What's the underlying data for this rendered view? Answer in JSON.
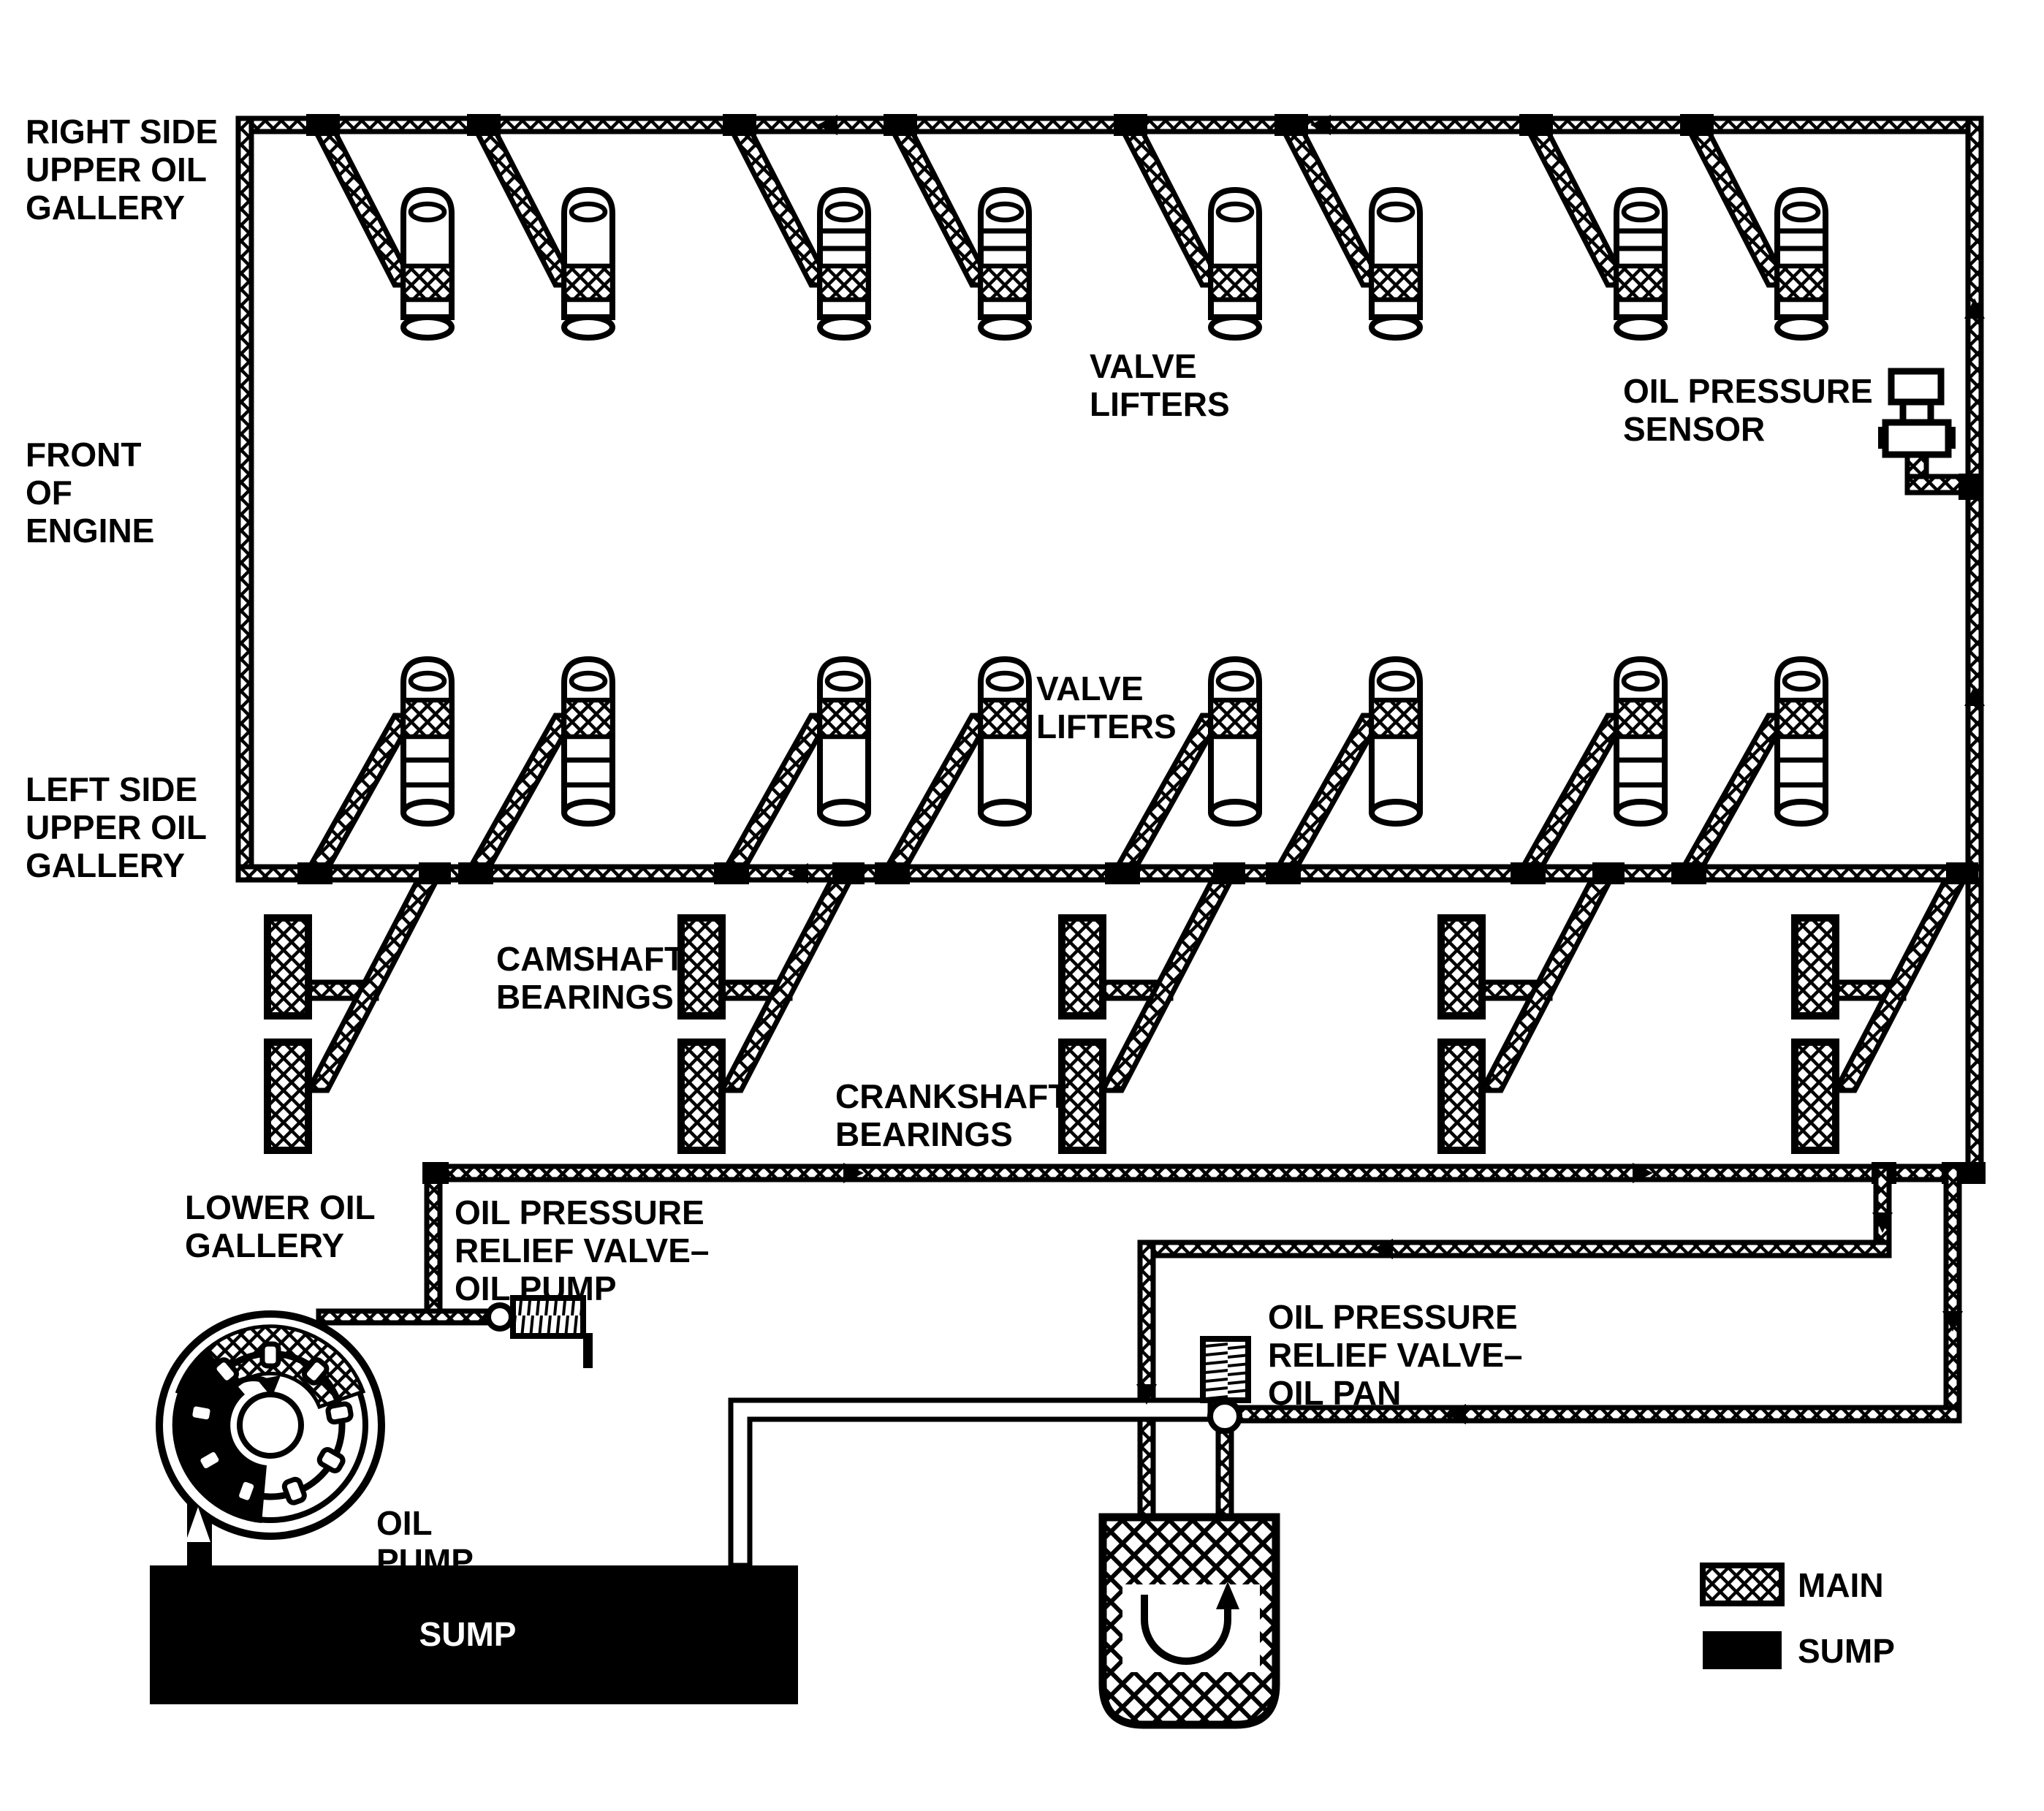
{
  "diagram_type": "engine-oil-lubrication-system",
  "colors": {
    "line": "#000000",
    "background": "#ffffff",
    "main_pipe_pattern": "black-white-crosshatch",
    "sump_fill": "#000000"
  },
  "labels": {
    "right_upper_gallery": {
      "lines": [
        "RIGHT SIDE",
        "UPPER OIL",
        "GALLERY"
      ]
    },
    "front_of_engine": {
      "lines": [
        "FRONT",
        "OF",
        "ENGINE"
      ]
    },
    "left_upper_gallery": {
      "lines": [
        "LEFT SIDE",
        "UPPER OIL",
        "GALLERY"
      ]
    },
    "valve_lifters_right_bank": {
      "lines": [
        "VALVE",
        "LIFTERS"
      ]
    },
    "valve_lifters_left_bank": {
      "lines": [
        "VALVE",
        "LIFTERS"
      ]
    },
    "oil_pressure_sensor": {
      "lines": [
        "OIL PRESSURE",
        "SENSOR"
      ]
    },
    "camshaft_bearings": {
      "lines": [
        "CAMSHAFT",
        "BEARINGS"
      ]
    },
    "crankshaft_bearings": {
      "lines": [
        "CRANKSHAFT",
        "BEARINGS"
      ]
    },
    "lower_oil_gallery": {
      "lines": [
        "LOWER OIL",
        "GALLERY"
      ]
    },
    "relief_valve_oil_pump": {
      "lines": [
        "OIL PRESSURE",
        "RELIEF VALVE–",
        "OIL PUMP"
      ]
    },
    "relief_valve_oil_pan": {
      "lines": [
        "OIL PRESSURE",
        "RELIEF VALVE–",
        "OIL PAN"
      ]
    },
    "oil_pump": {
      "lines": [
        "OIL",
        "PUMP"
      ]
    },
    "sump": "SUMP"
  },
  "legend": {
    "items": [
      {
        "label": "MAIN",
        "swatch": "crosshatch-pattern"
      },
      {
        "label": "SUMP",
        "swatch": "solid-black"
      }
    ]
  }
}
